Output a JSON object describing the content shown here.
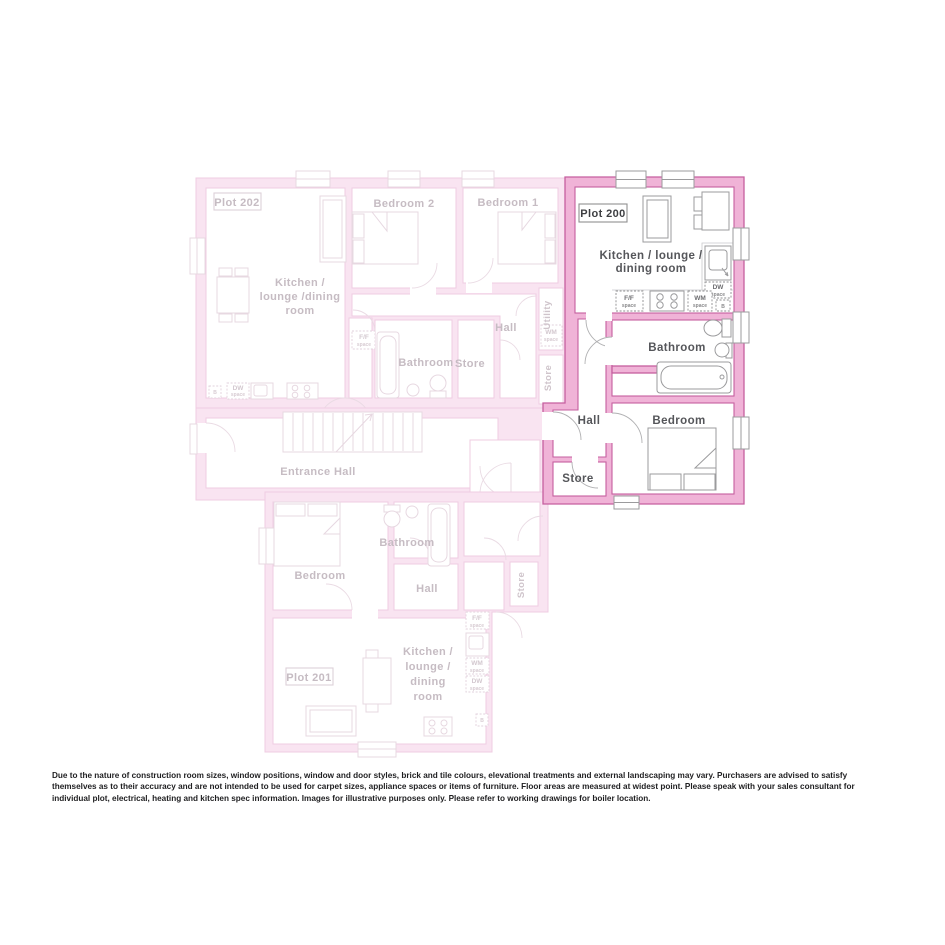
{
  "plot200": {
    "label": "Plot 200",
    "rooms": {
      "kitchen_l1": "Kitchen / lounge /",
      "kitchen_l2": "dining room",
      "bathroom": "Bathroom",
      "bedroom": "Bedroom",
      "hall": "Hall",
      "store": "Store"
    },
    "appliances": {
      "ff1": "F/F",
      "ff2": "space",
      "wm1": "WM",
      "wm2": "space",
      "dw1": "DW",
      "dw2": "space",
      "b": "B"
    }
  },
  "plot202": {
    "label": "Plot 202",
    "rooms": {
      "kitchen_l1": "Kitchen /",
      "kitchen_l2": "lounge /dining",
      "kitchen_l3": "room",
      "bedroom2": "Bedroom 2",
      "bedroom1": "Bedroom 1",
      "bathroom": "Bathroom",
      "store": "Store",
      "hall": "Hall",
      "utility": "Utility",
      "store2": "Store"
    },
    "appliances": {
      "ff1": "F/F",
      "ff2": "space",
      "wm1": "WM",
      "wm2": "space",
      "dw1": "DW",
      "dw2": "space",
      "b": "B"
    }
  },
  "plot201": {
    "label": "Plot 201",
    "rooms": {
      "kitchen_l1": "Kitchen /",
      "kitchen_l2": "lounge /",
      "kitchen_l3": "dining",
      "kitchen_l4": "room",
      "bedroom": "Bedroom",
      "bathroom": "Bathroom",
      "hall": "Hall",
      "store": "Store"
    },
    "appliances": {
      "ff1": "F/F",
      "ff2": "space",
      "wm1": "WM",
      "wm2": "space",
      "dw1": "DW",
      "dw2": "space",
      "b": "B"
    }
  },
  "entrance_hall": {
    "label": "Entrance Hall"
  },
  "colors": {
    "highlight_wall": "#f0b3d7",
    "highlight_outline": "#c55f9f",
    "faded_wall": "#f9e4f1",
    "faded_outline": "#efcce2",
    "label_dark": "#55565a",
    "label_faded": "#c6bcc3"
  },
  "disclaimer": "Due to the nature of construction room sizes, window positions, window and door styles, brick and tile colours, elevational treatments and external landscaping may vary. Purchasers are advised to satisfy themselves as to their accuracy and are not intended to be used for carpet sizes, appliance spaces or items of furniture. Floor areas are measured at widest point. Please speak with your sales consultant for individual plot, electrical, heating and kitchen spec information. Images for illustrative purposes only. Please refer to working drawings for boiler location."
}
